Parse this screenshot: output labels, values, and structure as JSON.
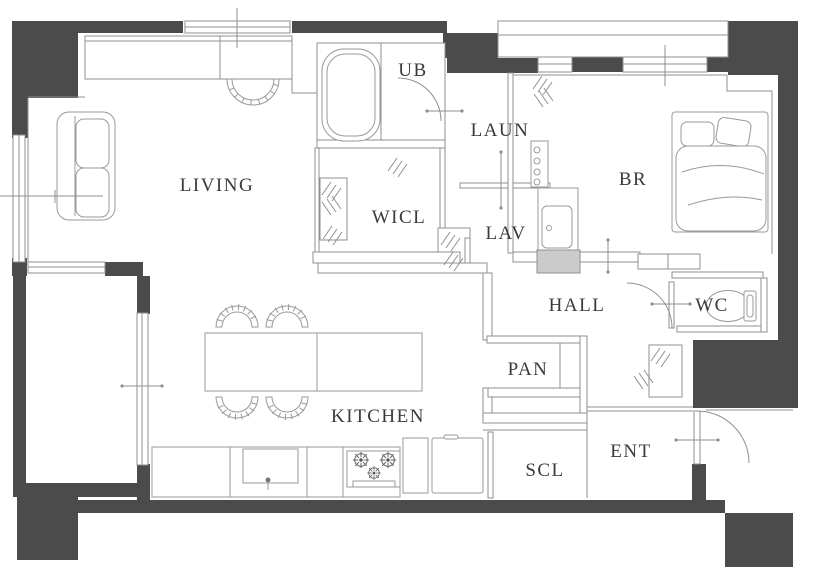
{
  "plan_title": "apartment-floor-plan",
  "palette": {
    "wall_fill": "#4b4b4b",
    "line": "#8f8f8f",
    "furniture_line": "#9a9a9a",
    "label_color": "#3a3a3a",
    "appliance_fill": "#cbcbcb",
    "background": "#ffffff"
  },
  "rooms": [
    {
      "id": "living",
      "label": "LIVING",
      "x": 217,
      "y": 186
    },
    {
      "id": "ub",
      "label": "UB",
      "x": 413,
      "y": 71
    },
    {
      "id": "laun",
      "label": "LAUN",
      "x": 500,
      "y": 131
    },
    {
      "id": "wicl",
      "label": "WICL",
      "x": 399,
      "y": 218
    },
    {
      "id": "lav",
      "label": "LAV",
      "x": 506,
      "y": 234
    },
    {
      "id": "br",
      "label": "BR",
      "x": 633,
      "y": 180
    },
    {
      "id": "hall",
      "label": "HALL",
      "x": 577,
      "y": 306
    },
    {
      "id": "wc",
      "label": "WC",
      "x": 712,
      "y": 306
    },
    {
      "id": "pan",
      "label": "PAN",
      "x": 528,
      "y": 370
    },
    {
      "id": "kitchen",
      "label": "KITCHEN",
      "x": 378,
      "y": 417
    },
    {
      "id": "scl",
      "label": "SCL",
      "x": 545,
      "y": 471
    },
    {
      "id": "ent",
      "label": "ENT",
      "x": 631,
      "y": 452
    }
  ],
  "fixtures": [
    "bathtub-icon",
    "bed-icon",
    "pillow-icon",
    "toilet-icon",
    "washbasin-icon",
    "sofa-icon",
    "dining-table-icon",
    "dining-chair-icon",
    "kitchen-sink-icon",
    "cooktop-icon",
    "refrigerator-icon",
    "washer-unit-icon",
    "door-swing-icon",
    "window-icon",
    "hatch-mark-icon"
  ]
}
